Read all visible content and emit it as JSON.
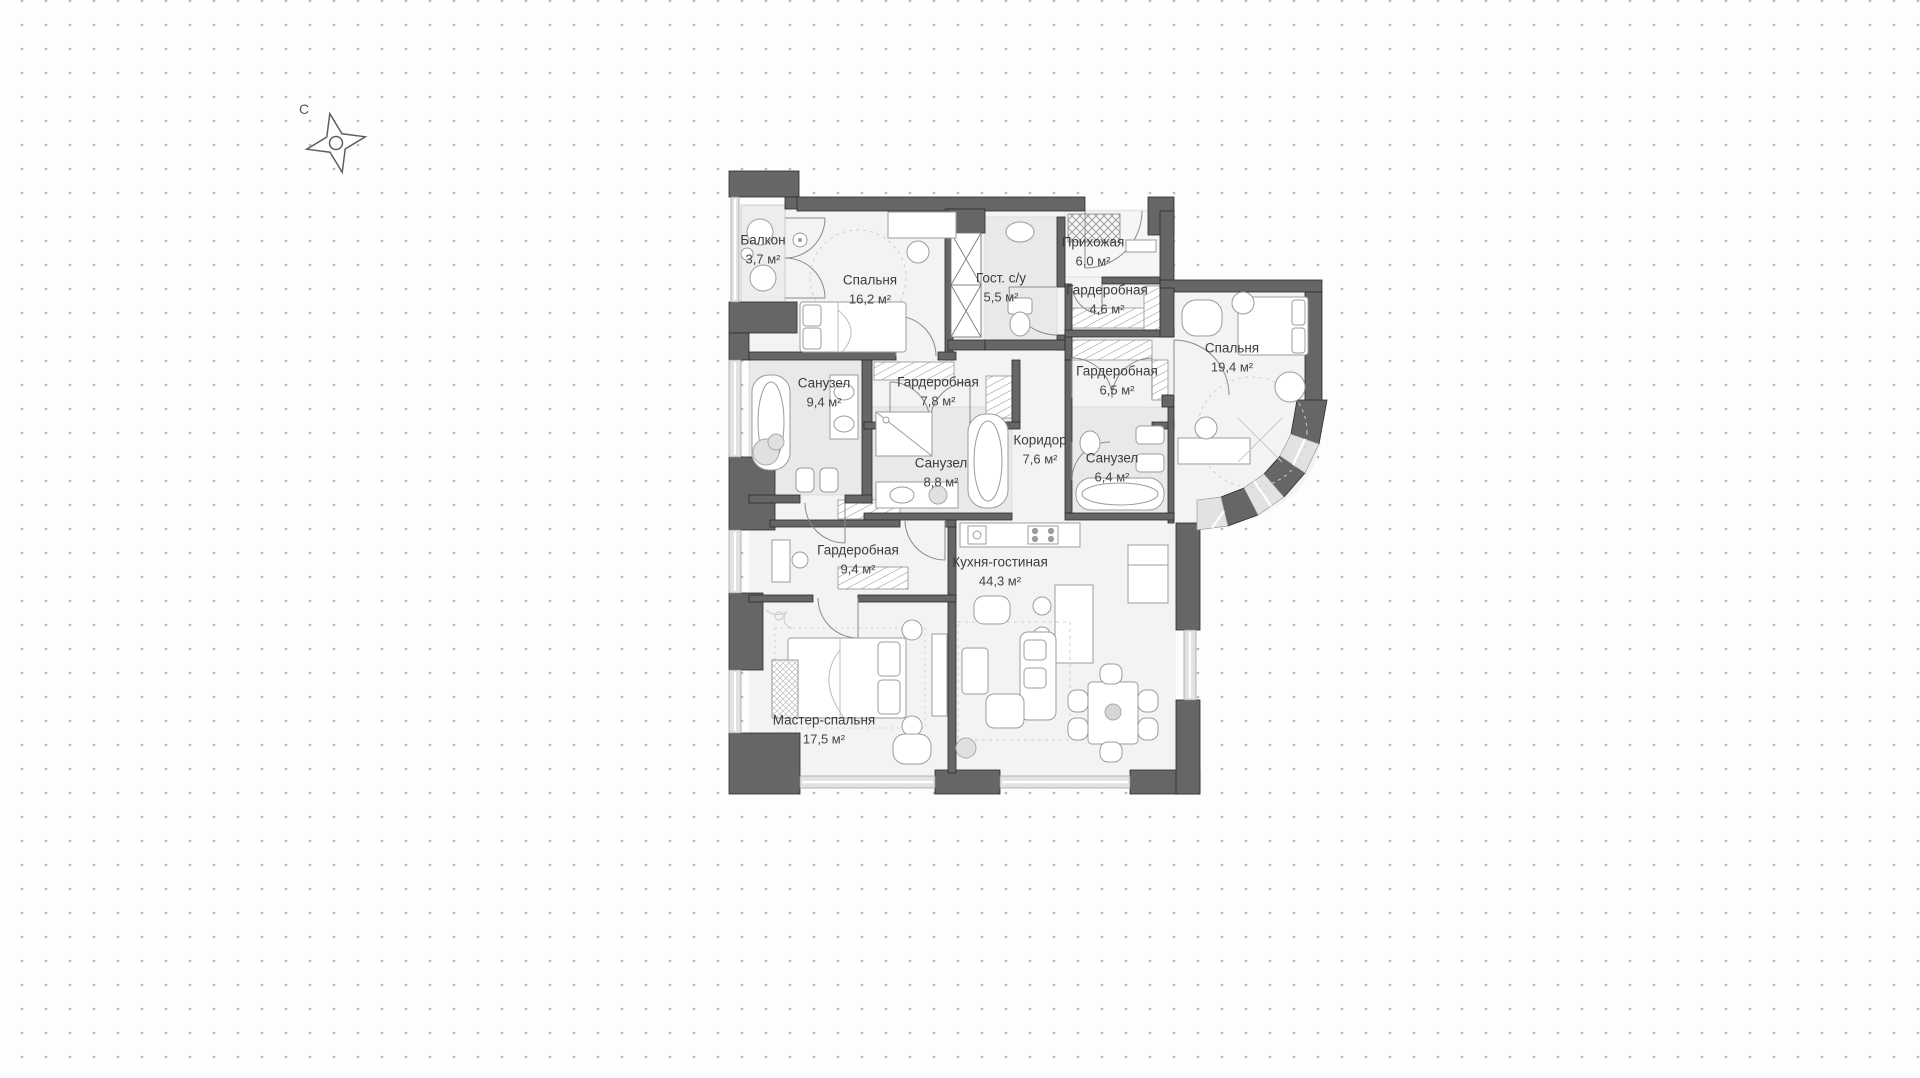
{
  "compass": {
    "north_label": "С"
  },
  "rooms": [
    {
      "id": "balcony",
      "name": "Балкон",
      "area": "3,7 м²"
    },
    {
      "id": "bedroom-16",
      "name": "Спальня",
      "area": "16,2 м²"
    },
    {
      "id": "guest-wc",
      "name": "Гост. с/у",
      "area": "5,5 м²"
    },
    {
      "id": "entry-hall",
      "name": "Прихожая",
      "area": "6,0 м²"
    },
    {
      "id": "wardrobe-46",
      "name": "Гардеробная",
      "area": "4,6 м²"
    },
    {
      "id": "bedroom-19",
      "name": "Спальня",
      "area": "19,4 м²"
    },
    {
      "id": "bathroom-94",
      "name": "Санузел",
      "area": "9,4 м²"
    },
    {
      "id": "wardrobe-78",
      "name": "Гардеробная",
      "area": "7,8 м²"
    },
    {
      "id": "wardrobe-65",
      "name": "Гардеробная",
      "area": "6,5 м²"
    },
    {
      "id": "corridor",
      "name": "Коридор",
      "area": "7,6 м²"
    },
    {
      "id": "bathroom-88",
      "name": "Санузел",
      "area": "8,8 м²"
    },
    {
      "id": "bathroom-64",
      "name": "Санузел",
      "area": "6,4 м²"
    },
    {
      "id": "wardrobe-94",
      "name": "Гардеробная",
      "area": "9,4 м²"
    },
    {
      "id": "kitchen-living",
      "name": "Кухня-гостиная",
      "area": "44,3 м²"
    },
    {
      "id": "master-bedroom",
      "name": "Мастер-спальня",
      "area": "17,5 м²"
    }
  ],
  "colors": {
    "wall": "#666666",
    "wall_outline": "#2b2b2b",
    "floor": "#f3f3f3",
    "tile": "#e9e9e9",
    "window": "#e2e2e2",
    "dot_grid": "#b9b9b9",
    "label_text": "#3c3c3c"
  }
}
